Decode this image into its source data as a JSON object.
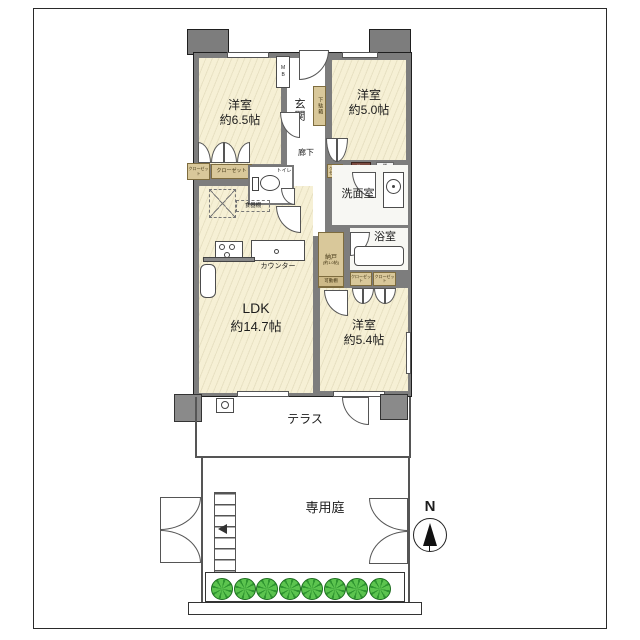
{
  "plan": {
    "rooms": {
      "west65": {
        "name": "洋室",
        "size": "約6.5帖"
      },
      "west50": {
        "name": "洋室",
        "size": "約5.0帖"
      },
      "west54": {
        "name": "洋室",
        "size": "約5.4帖"
      },
      "ldk": {
        "name": "LDK",
        "size": "約14.7帖"
      },
      "genkan": "玄関",
      "rouka": "廊下",
      "toilet": "トイレ",
      "senmen": "洗面室",
      "bath": "浴室",
      "nando": "納戸",
      "nando_size": "(約1.0帖)",
      "terrace": "テラス",
      "garden": "専用庭"
    },
    "fixtures": {
      "mb": "MB",
      "getabako": "下駄箱",
      "closet": "クローゼット",
      "shokkidana": "食器棚",
      "kadoudana": "可動棚",
      "counter": "カウンター",
      "monoire": "物入",
      "tana": "棚"
    },
    "compass": {
      "north": "N"
    },
    "colors": {
      "wall": "#7d7d7d",
      "room": "#f6f0d5",
      "storage": "#d9c89a",
      "bush": "#55bd4a"
    }
  }
}
